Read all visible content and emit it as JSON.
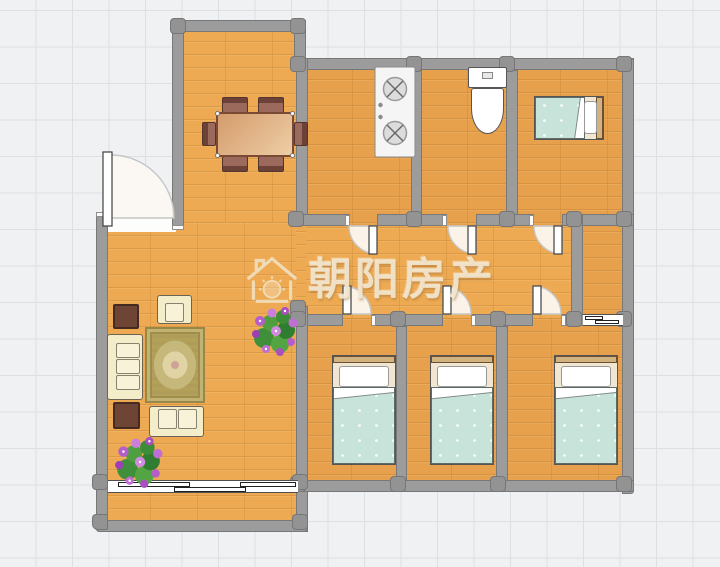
{
  "watermark": {
    "text": "朝阳房产",
    "icon": "house-sun-icon"
  },
  "colors": {
    "grid_background": "#eff1f3",
    "grid_line": "#dcdfe4",
    "wall_gray": "#9c9c9c",
    "wood_floor": "#edaa52",
    "bed_blanket_mint": "#c7e3da",
    "sofa_cream": "#f3edca",
    "rug_olive": "#b2a158",
    "side_table_brown": "#6e4434",
    "dining_chair_brown": "#9b6a5c",
    "flower_purple": "#b55ecb",
    "plant_green": "#4a9e3f",
    "watermark_cream": "#f2e6cc"
  }
}
